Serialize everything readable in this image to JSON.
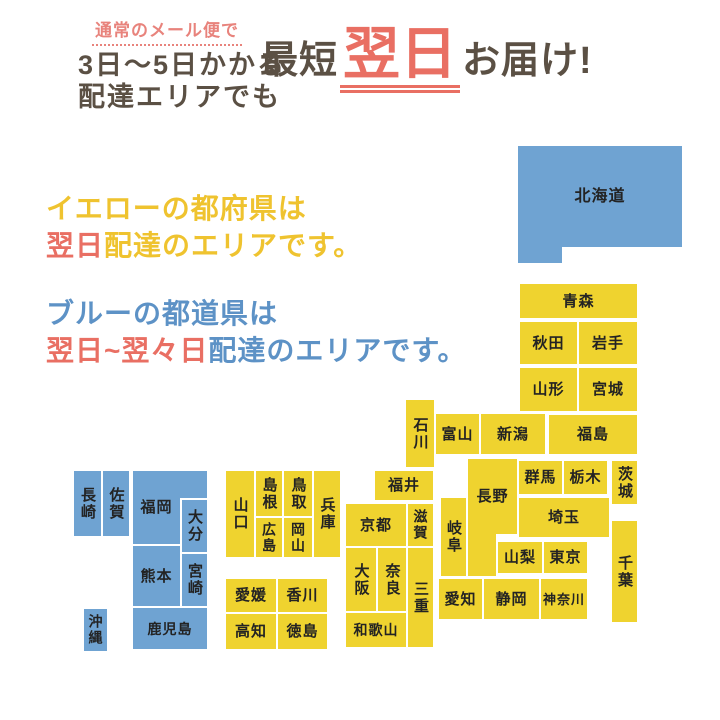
{
  "banner": {
    "note_line1": "通常のメール便で",
    "note_line2": "3日〜5日かかる",
    "note_line3": "配達エリアでも",
    "headline_prefix": "最短",
    "headline_highlight": "翌日",
    "headline_suffix": "お届け!"
  },
  "legend": {
    "yellow_line1": "イエローの都府県は",
    "yellow_line2_highlight": "翌日",
    "yellow_line2_rest": "配達のエリアです。",
    "blue_line1": "ブルーの都道県は",
    "blue_line2_highlight": "翌日~翌々日",
    "blue_line2_rest": "配達のエリアです。"
  },
  "colors": {
    "map_yellow": "#efd32f",
    "map_blue": "#6fa3d2",
    "accent_red": "#e96f63",
    "text_dark": "#5b5044",
    "note_pink": "#e8837c",
    "legend_yellow_text": "#efc32f",
    "legend_blue_text": "#5d92c6",
    "block_label": "#232323"
  },
  "map": {
    "yellow_meaning": "next-day delivery area",
    "blue_meaning": "next-day to two-day delivery area",
    "blocks": [
      {
        "id": "hokkaido",
        "label": "北海道",
        "color": "blue",
        "x": 517,
        "y": 145,
        "w": 166,
        "h": 103,
        "o": "h",
        "fs": 16
      },
      {
        "id": "hokkaido-leg",
        "label": "",
        "color": "blue",
        "x": 518,
        "y": 240,
        "w": 44,
        "h": 23,
        "ext": true
      },
      {
        "id": "aomori",
        "label": "青森",
        "color": "yellow",
        "x": 519,
        "y": 283,
        "w": 119,
        "h": 36,
        "o": "h"
      },
      {
        "id": "akita",
        "label": "秋田",
        "color": "yellow",
        "x": 519,
        "y": 321,
        "w": 59,
        "h": 44,
        "o": "h"
      },
      {
        "id": "iwate",
        "label": "岩手",
        "color": "yellow",
        "x": 578,
        "y": 321,
        "w": 60,
        "h": 44,
        "o": "h"
      },
      {
        "id": "yamagata",
        "label": "山形",
        "color": "yellow",
        "x": 519,
        "y": 367,
        "w": 59,
        "h": 45,
        "o": "h"
      },
      {
        "id": "miyagi",
        "label": "宮城",
        "color": "yellow",
        "x": 578,
        "y": 367,
        "w": 60,
        "h": 45,
        "o": "h"
      },
      {
        "id": "fukushima",
        "label": "福島",
        "color": "yellow",
        "x": 548,
        "y": 414,
        "w": 90,
        "h": 41,
        "o": "h"
      },
      {
        "id": "niigata",
        "label": "新潟",
        "color": "yellow",
        "x": 480,
        "y": 413,
        "w": 66,
        "h": 42,
        "o": "h"
      },
      {
        "id": "toyama",
        "label": "富山",
        "color": "yellow",
        "x": 435,
        "y": 413,
        "w": 45,
        "h": 42,
        "o": "h"
      },
      {
        "id": "ishikawa",
        "label": "石川",
        "color": "yellow",
        "x": 405,
        "y": 399,
        "w": 30,
        "h": 69,
        "o": "v"
      },
      {
        "id": "fukui",
        "label": "福井",
        "color": "yellow",
        "x": 374,
        "y": 470,
        "w": 60,
        "h": 31,
        "o": "h"
      },
      {
        "id": "gunma",
        "label": "群馬",
        "color": "yellow",
        "x": 518,
        "y": 460,
        "w": 45,
        "h": 35,
        "o": "h"
      },
      {
        "id": "tochigi",
        "label": "栃木",
        "color": "yellow",
        "x": 563,
        "y": 460,
        "w": 45,
        "h": 35,
        "o": "h"
      },
      {
        "id": "ibaraki",
        "label": "茨城",
        "color": "yellow",
        "x": 611,
        "y": 460,
        "w": 27,
        "h": 45,
        "o": "v"
      },
      {
        "id": "nagano",
        "label": "長野",
        "color": "yellow",
        "x": 467,
        "y": 458,
        "w": 51,
        "h": 77,
        "o": "h"
      },
      {
        "id": "nagano-south",
        "label": "",
        "color": "yellow",
        "x": 468,
        "y": 531,
        "w": 28,
        "h": 45,
        "ext": true
      },
      {
        "id": "saitama",
        "label": "埼玉",
        "color": "yellow",
        "x": 518,
        "y": 497,
        "w": 92,
        "h": 41,
        "o": "h"
      },
      {
        "id": "gifu",
        "label": "岐阜",
        "color": "yellow",
        "x": 440,
        "y": 497,
        "w": 27,
        "h": 80,
        "o": "v"
      },
      {
        "id": "yamanashi",
        "label": "山梨",
        "color": "yellow",
        "x": 497,
        "y": 541,
        "w": 46,
        "h": 33,
        "o": "h"
      },
      {
        "id": "tokyo",
        "label": "東京",
        "color": "yellow",
        "x": 543,
        "y": 541,
        "w": 45,
        "h": 33,
        "o": "h"
      },
      {
        "id": "chiba",
        "label": "千葉",
        "color": "yellow",
        "x": 611,
        "y": 520,
        "w": 27,
        "h": 103,
        "o": "v"
      },
      {
        "id": "kanagawa",
        "label": "神奈川",
        "color": "yellow",
        "x": 540,
        "y": 578,
        "w": 48,
        "h": 42,
        "o": "h",
        "fs": 13
      },
      {
        "id": "shizuoka",
        "label": "静岡",
        "color": "yellow",
        "x": 483,
        "y": 578,
        "w": 57,
        "h": 42,
        "o": "h"
      },
      {
        "id": "aichi",
        "label": "愛知",
        "color": "yellow",
        "x": 438,
        "y": 578,
        "w": 45,
        "h": 42,
        "o": "h"
      },
      {
        "id": "shiga",
        "label": "滋賀",
        "color": "yellow",
        "x": 407,
        "y": 503,
        "w": 27,
        "h": 44,
        "o": "v",
        "fs": 14
      },
      {
        "id": "kyoto",
        "label": "京都",
        "color": "yellow",
        "x": 345,
        "y": 503,
        "w": 62,
        "h": 44,
        "o": "h"
      },
      {
        "id": "mie",
        "label": "三重",
        "color": "yellow",
        "x": 407,
        "y": 547,
        "w": 27,
        "h": 101,
        "o": "v"
      },
      {
        "id": "osaka",
        "label": "大阪",
        "color": "yellow",
        "x": 345,
        "y": 547,
        "w": 32,
        "h": 65,
        "o": "v"
      },
      {
        "id": "nara",
        "label": "奈良",
        "color": "yellow",
        "x": 377,
        "y": 547,
        "w": 30,
        "h": 65,
        "o": "v"
      },
      {
        "id": "wakayama",
        "label": "和歌山",
        "color": "yellow",
        "x": 345,
        "y": 612,
        "w": 62,
        "h": 36,
        "o": "h",
        "fs": 14
      },
      {
        "id": "hyogo",
        "label": "兵庫",
        "color": "yellow",
        "x": 313,
        "y": 470,
        "w": 28,
        "h": 88,
        "o": "v"
      },
      {
        "id": "tottori",
        "label": "鳥取",
        "color": "yellow",
        "x": 283,
        "y": 470,
        "w": 30,
        "h": 47,
        "o": "v"
      },
      {
        "id": "shimane",
        "label": "島根",
        "color": "yellow",
        "x": 255,
        "y": 470,
        "w": 28,
        "h": 47,
        "o": "v"
      },
      {
        "id": "yamaguchi",
        "label": "山口",
        "color": "yellow",
        "x": 225,
        "y": 470,
        "w": 30,
        "h": 88,
        "o": "v"
      },
      {
        "id": "okayama",
        "label": "岡山",
        "color": "yellow",
        "x": 283,
        "y": 517,
        "w": 30,
        "h": 41,
        "o": "v",
        "fs": 14
      },
      {
        "id": "hiroshima",
        "label": "広島",
        "color": "yellow",
        "x": 255,
        "y": 517,
        "w": 28,
        "h": 41,
        "o": "v",
        "fs": 14
      },
      {
        "id": "ehime",
        "label": "愛媛",
        "color": "yellow",
        "x": 225,
        "y": 578,
        "w": 52,
        "h": 35,
        "o": "h"
      },
      {
        "id": "kagawa",
        "label": "香川",
        "color": "yellow",
        "x": 277,
        "y": 578,
        "w": 51,
        "h": 35,
        "o": "h"
      },
      {
        "id": "kochi",
        "label": "高知",
        "color": "yellow",
        "x": 225,
        "y": 613,
        "w": 52,
        "h": 37,
        "o": "h"
      },
      {
        "id": "tokushima",
        "label": "徳島",
        "color": "yellow",
        "x": 277,
        "y": 613,
        "w": 51,
        "h": 37,
        "o": "h"
      },
      {
        "id": "nagasaki",
        "label": "長崎",
        "color": "blue",
        "x": 73,
        "y": 470,
        "w": 29,
        "h": 67,
        "o": "v"
      },
      {
        "id": "saga",
        "label": "佐賀",
        "color": "blue",
        "x": 102,
        "y": 470,
        "w": 28,
        "h": 67,
        "o": "v"
      },
      {
        "id": "fukuoka",
        "label": "福岡",
        "color": "blue",
        "x": 132,
        "y": 470,
        "w": 49,
        "h": 75,
        "o": "h"
      },
      {
        "id": "fukuoka-ne",
        "label": "",
        "color": "blue",
        "x": 178,
        "y": 471,
        "w": 29,
        "h": 27,
        "ext": true
      },
      {
        "id": "oita",
        "label": "大分",
        "color": "blue",
        "x": 181,
        "y": 499,
        "w": 27,
        "h": 54,
        "o": "v"
      },
      {
        "id": "kumamoto",
        "label": "熊本",
        "color": "blue",
        "x": 132,
        "y": 545,
        "w": 49,
        "h": 62,
        "o": "h"
      },
      {
        "id": "miyazaki",
        "label": "宮崎",
        "color": "blue",
        "x": 181,
        "y": 553,
        "w": 27,
        "h": 54,
        "o": "v"
      },
      {
        "id": "kagoshima",
        "label": "鹿児島",
        "color": "blue",
        "x": 132,
        "y": 607,
        "w": 76,
        "h": 43,
        "o": "h",
        "fs": 14
      },
      {
        "id": "okinawa",
        "label": "沖縄",
        "color": "blue",
        "x": 83,
        "y": 608,
        "w": 25,
        "h": 44,
        "o": "v",
        "fs": 14
      }
    ]
  }
}
